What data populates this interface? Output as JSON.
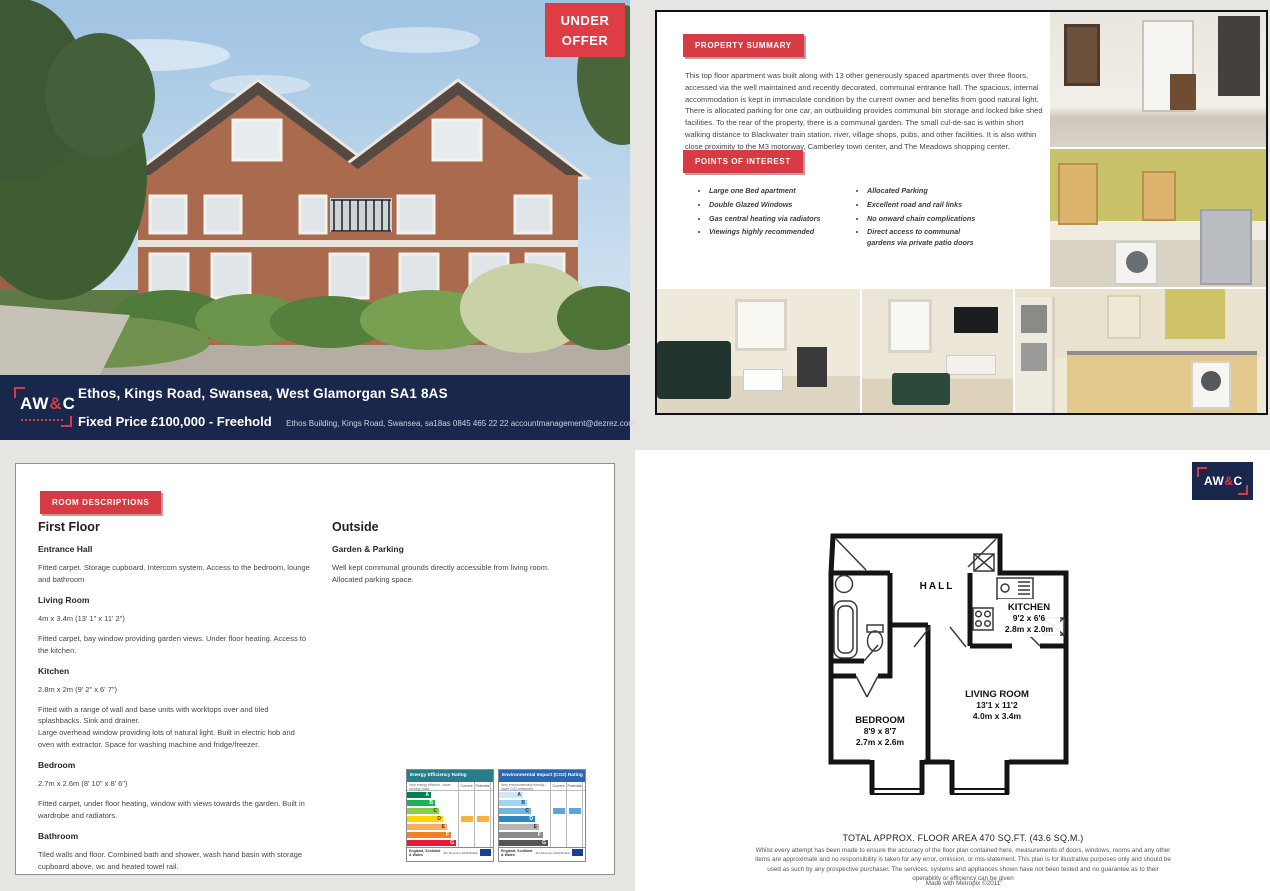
{
  "cover": {
    "under_offer_line1": "UNDER",
    "under_offer_line2": "OFFER",
    "banner": {
      "logo_aw": "AW",
      "logo_amp": "&",
      "logo_c": "C",
      "address": "Ethos, Kings Road, Swansea, West Glamorgan  SA1 8AS",
      "price": "Fixed Price £100,000 - Freehold",
      "contact": "Ethos Building, Kings Road, Swansea, sa18as   0845 465 22 22   accountmanagement@dezrez.com"
    }
  },
  "summary_panel": {
    "summary_badge": "PROPERTY SUMMARY",
    "summary_text": "This top floor apartment was built along with 13 other generously spaced apartments over three floors, accessed via the well maintained and recently decorated, communal entrance hall. The spacious, internal accommodation is kept in immaculate condition by the current owner and benefits from good natural light. There is allocated parking for one car, an outbuilding provides communal bin storage and locked bike shed facilities. To the rear of the property, there is a communal garden. The small cul-de-sac is within short walking distance to Blackwater train station, river, village shops, pubs, and other facilities. It is also within close proximity to the M3 motorway, Camberley town center, and The Meadows shopping center.",
    "poi_badge": "POINTS OF INTEREST",
    "poi_left": [
      "Large one Bed apartment",
      "Double Glazed Windows",
      "Gas central heating via radiators",
      "Viewings highly recommended"
    ],
    "poi_right": [
      "Allocated Parking",
      "Excellent road and rail links",
      "No onward chain complications",
      "Direct access to communal gardens via private patio doors"
    ]
  },
  "rooms_panel": {
    "badge": "ROOM DESCRIPTIONS",
    "first_floor_heading": "First Floor",
    "sections": [
      {
        "title": "Entrance Hall",
        "body": "Fitted carpet. Storage cupboard. Intercom system. Access to the bedroom, lounge and bathroom"
      },
      {
        "title": "Living Room",
        "dims": "4m x 3.4m (13' 1\" x 11' 2\")",
        "body": "Fitted carpet, bay window providing garden views. Under floor heating. Access to the kitchen."
      },
      {
        "title": "Kitchen",
        "dims": "2.8m x 2m (9' 2\" x 6' 7\")",
        "body": "Fitted with a range of wall and base units with worktops over and tiled splashbacks. Sink and drainer.\nLarge overhead window providing lots of natural light. Built in electric hob and oven with extractor. Space for washing machine and fridge/freezer."
      },
      {
        "title": "Bedroom",
        "dims": "2.7m x 2.6m (8' 10\" x 8' 6\")",
        "body": "Fitted carpet, under floor heating, window with views towards the garden. Built in wardrobe and radiators."
      },
      {
        "title": "Bathroom",
        "body": "Tiled walls and floor. Combined bath and shower, wash hand basin with storage cupboard above, wc and heated towel rail."
      }
    ],
    "outside_heading": "Outside",
    "outside_sub": "Garden & Parking",
    "outside_body": "Well kept communal grounds directly accessible from living room.\nAllocated parking space."
  },
  "epc_charts": [
    {
      "title": "Energy Efficiency Rating",
      "header_color": "#2a7c8a",
      "top_note": "Very energy efficient - lower running costs",
      "col_current": "Current",
      "col_potential": "Potential",
      "bars": [
        {
          "letter": "A",
          "color": "#008054",
          "text": "#ffffff",
          "width": 24
        },
        {
          "letter": "B",
          "color": "#19b459",
          "text": "#ffffff",
          "width": 28
        },
        {
          "letter": "C",
          "color": "#8dce46",
          "text": "#23401a",
          "width": 32
        },
        {
          "letter": "D",
          "color": "#ffd500",
          "text": "#4a3c00",
          "width": 36
        },
        {
          "letter": "E",
          "color": "#fcaa65",
          "text": "#5a3414",
          "width": 40
        },
        {
          "letter": "F",
          "color": "#ef8023",
          "text": "#ffffff",
          "width": 44
        },
        {
          "letter": "G",
          "color": "#e9153b",
          "text": "#ffffff",
          "width": 49
        }
      ],
      "current_row": 3,
      "potential_row": 3,
      "marker_color": "#f5b33b",
      "footer_left": "England, Scotland & Wales",
      "footer_right": "EU Directive 2002/91/EC"
    },
    {
      "title": "Environmental Impact (CO2) Rating",
      "header_color": "#2b66b1",
      "top_note": "Very environmentally friendly - lower CO2 emissions",
      "col_current": "Current",
      "col_potential": "Potential",
      "bars": [
        {
          "letter": "A",
          "color": "#cfe7f6",
          "text": "#1e3a52",
          "width": 24
        },
        {
          "letter": "B",
          "color": "#a6d3ee",
          "text": "#1e3a52",
          "width": 28
        },
        {
          "letter": "C",
          "color": "#6fb6e0",
          "text": "#10293d",
          "width": 32
        },
        {
          "letter": "D",
          "color": "#2c87c8",
          "text": "#ffffff",
          "width": 36
        },
        {
          "letter": "E",
          "color": "#b5b5b5",
          "text": "#2c2c2c",
          "width": 40
        },
        {
          "letter": "F",
          "color": "#8a8a8a",
          "text": "#ffffff",
          "width": 44
        },
        {
          "letter": "G",
          "color": "#555555",
          "text": "#ffffff",
          "width": 49
        }
      ],
      "current_row": 2,
      "potential_row": 2,
      "marker_color": "#5aa7d6",
      "footer_left": "England, Scotland & Wales",
      "footer_right": "EU Directive 2002/91/EC"
    }
  ],
  "floorplan_panel": {
    "logo_aw": "AW",
    "logo_amp": "&",
    "logo_c": "C",
    "hall_label": "HALL",
    "kitchen_label": "KITCHEN",
    "kitchen_imperial": "9'2 x 6'6",
    "kitchen_metric": "2.8m x 2.0m",
    "living_label": "LIVING ROOM",
    "living_imperial": "13'1 x 11'2",
    "living_metric": "4.0m x 3.4m",
    "bedroom_label": "BEDROOM",
    "bedroom_imperial": "8'9 x 8'7",
    "bedroom_metric": "2.7m x 2.6m",
    "total_area": "TOTAL APPROX. FLOOR AREA 470 SQ.FT. (43.6 SQ.M.)",
    "disclaimer": "Whilst every attempt has been made to ensure the accuracy of the floor plan contained here, measurements of doors, windows, rooms and any other items are approximate and no responsibility is taken for any error, omission, or mis-statement. This plan is for illustrative purposes only and should be used as such by any prospective purchaser. The services, systems and appliances shown have not been tested and no guarantee as to their operability or efficiency can be given",
    "made_with": "Made with Metropix ©2011"
  },
  "colors": {
    "brand_navy": "#1a274d",
    "brand_red": "#d63a42"
  }
}
